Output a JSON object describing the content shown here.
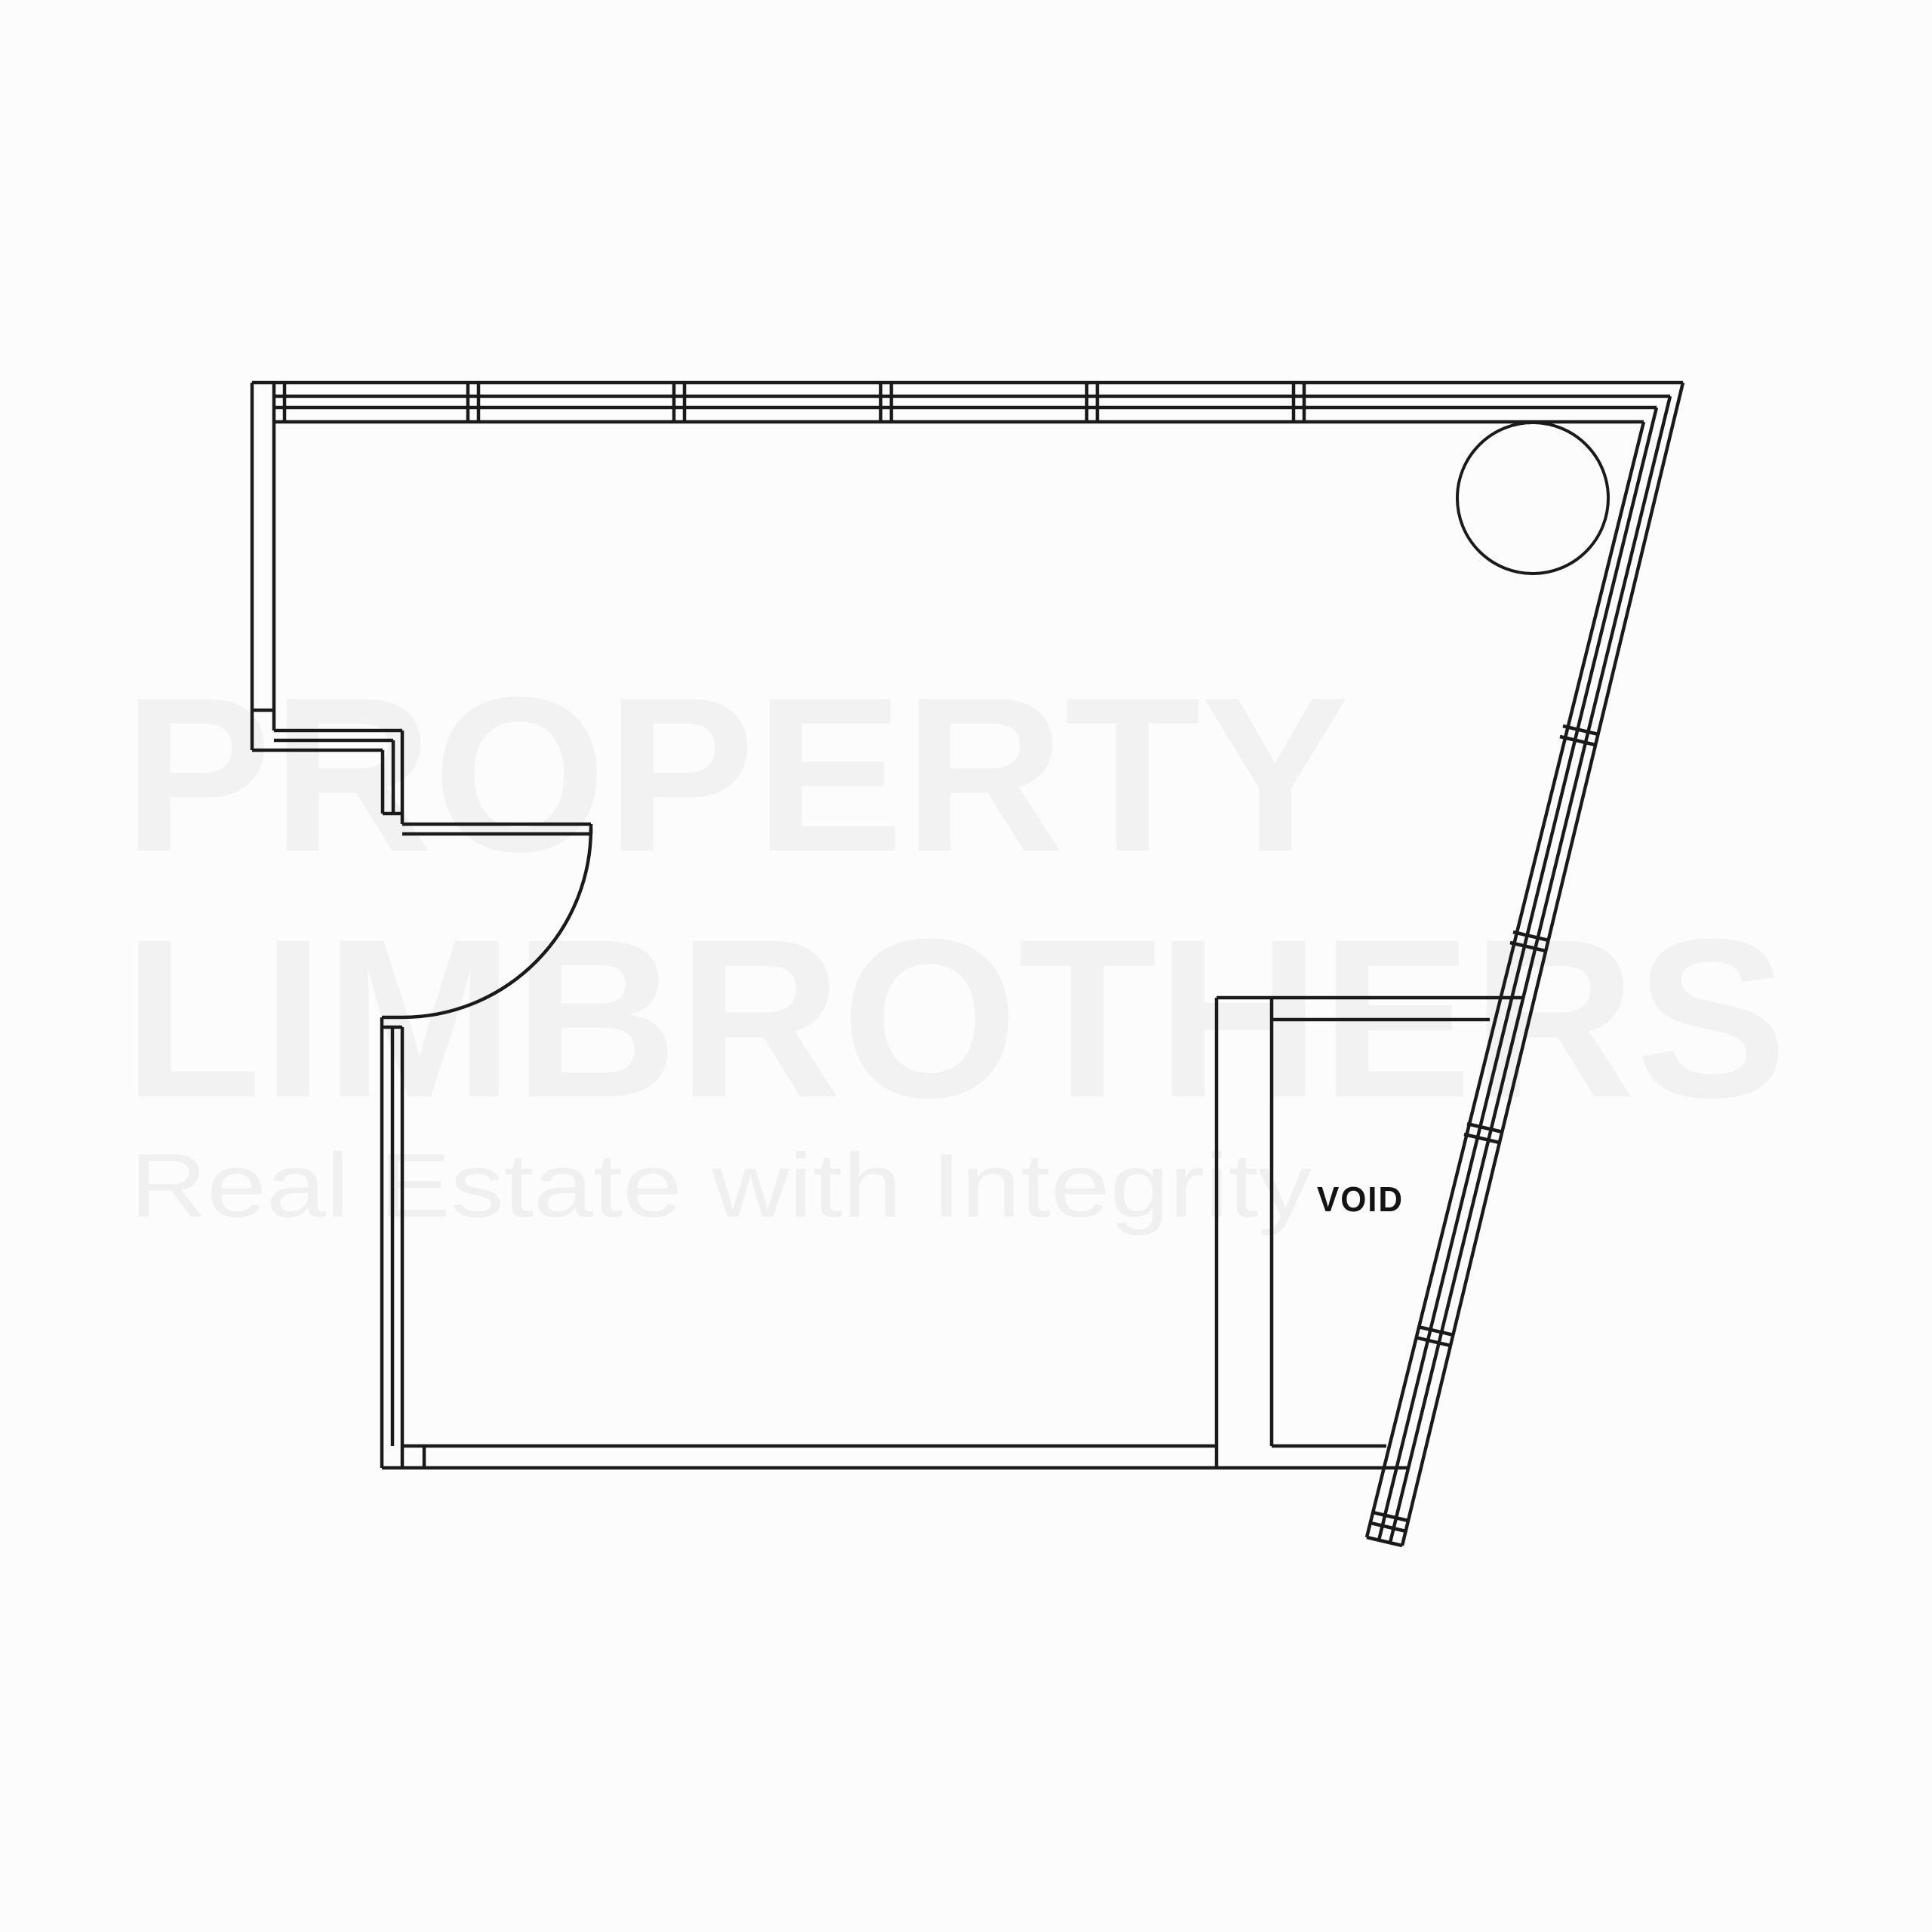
{
  "page": {
    "background": "#fcfcfc"
  },
  "watermark": {
    "line1": "PROPERTY",
    "line2": "LIMBROTHERS",
    "tagline": "Real Estate with Integrity",
    "color": "#f2f2f2",
    "tagline_color": "#f0f0f0"
  },
  "floorplan": {
    "room_label": "VOID",
    "label_color": "#141414",
    "line_color": "#1a1a1a",
    "features": [
      "top-window-wall-with-mullions",
      "left-wall-step",
      "entry-door-swing",
      "bottom-wall",
      "diagonal-window-wall",
      "void-shaft-room",
      "column-circle"
    ]
  }
}
